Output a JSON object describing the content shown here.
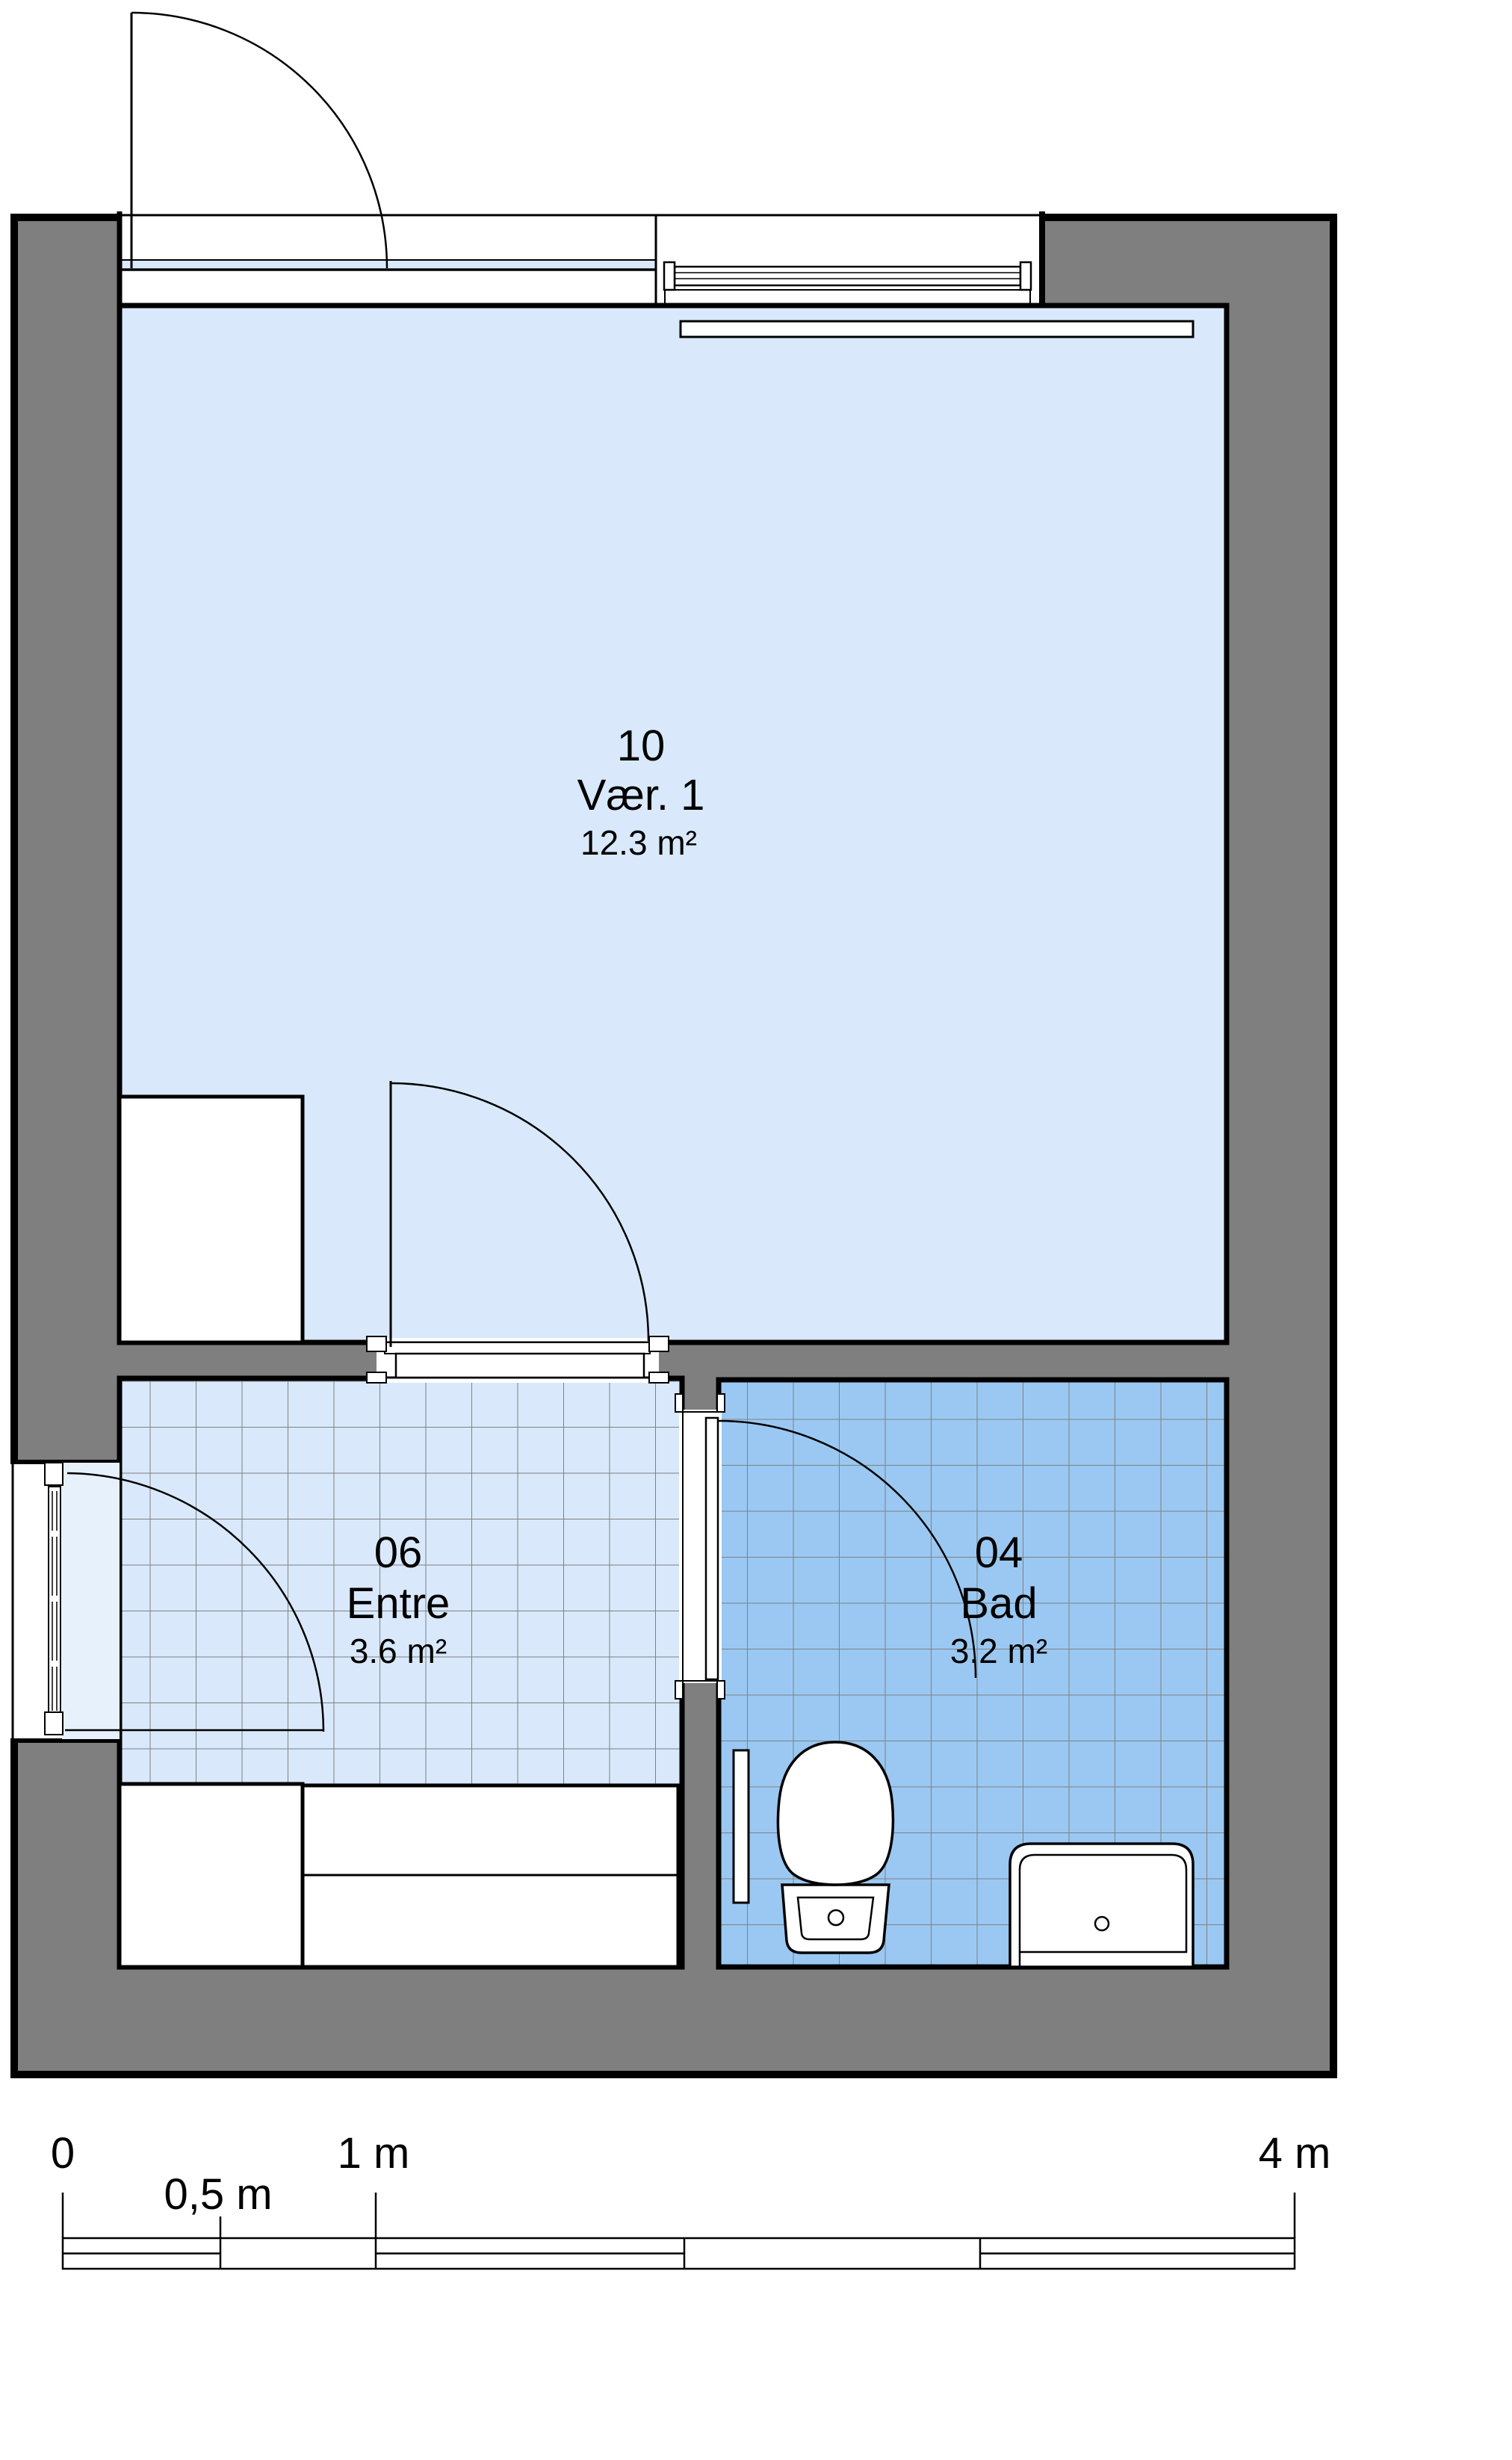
{
  "plan": {
    "rooms": [
      {
        "number": "10",
        "name": "Vær. 1",
        "area": "12.3 m²"
      },
      {
        "number": "06",
        "name": "Entre",
        "area": "3.6 m²"
      },
      {
        "number": "04",
        "name": "Bad",
        "area": "3.2 m²"
      }
    ],
    "colors": {
      "wall": "#7f7f7f",
      "room_light": "#d9e9fb",
      "bad_tile": "#9ac8f2",
      "threshold": "#e7f1fc",
      "sidelight": "#d9e9fb",
      "grid": "#808080"
    },
    "scale_bar": {
      "tick_0": "0",
      "tick_05": "0,5 m",
      "tick_1": "1 m",
      "tick_4": "4 m"
    }
  }
}
